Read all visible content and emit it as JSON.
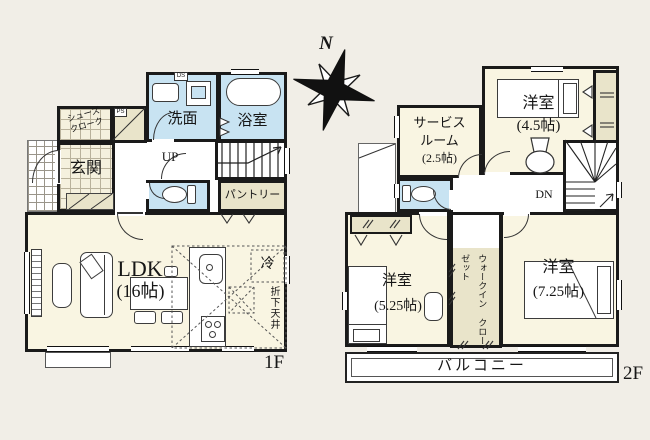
{
  "compass": {
    "north": "N"
  },
  "floor1": {
    "floor_tag": "1F",
    "washroom": "洗面",
    "bathroom": "浴室",
    "shoes_closet_line1": "シューズ",
    "shoes_closet_line2": "クローク",
    "entrance": "玄関",
    "stairs_up": "UP",
    "pantry": "パントリー",
    "ldk_name": "LDK",
    "ldk_size": "(16帖)",
    "fridge": "冷",
    "dropped_ceiling": "折下天井",
    "duct_space": "DS",
    "pipe_space": "PS"
  },
  "floor2": {
    "floor_tag": "2F",
    "service_room_line1": "サービス",
    "service_room_line2": "ルーム",
    "service_room_size": "(2.5帖)",
    "bedroom_north_name": "洋室",
    "bedroom_north_size": "(4.5帖)",
    "stairs_down": "DN",
    "bedroom_west_name": "洋室",
    "bedroom_west_size": "(5.25帖)",
    "wic_line1": "ウォークイン",
    "wic_line2": "クローゼット",
    "bedroom_east_name": "洋室",
    "bedroom_east_size": "(7.25帖)",
    "balcony": "バルコニー"
  },
  "colors": {
    "wall": "#1a1a1a",
    "room_cream": "#f9f5e2",
    "wet_area_blue": "#c8e3f2",
    "storage_beige": "#e9e4ca",
    "background": "#f1eee7"
  }
}
